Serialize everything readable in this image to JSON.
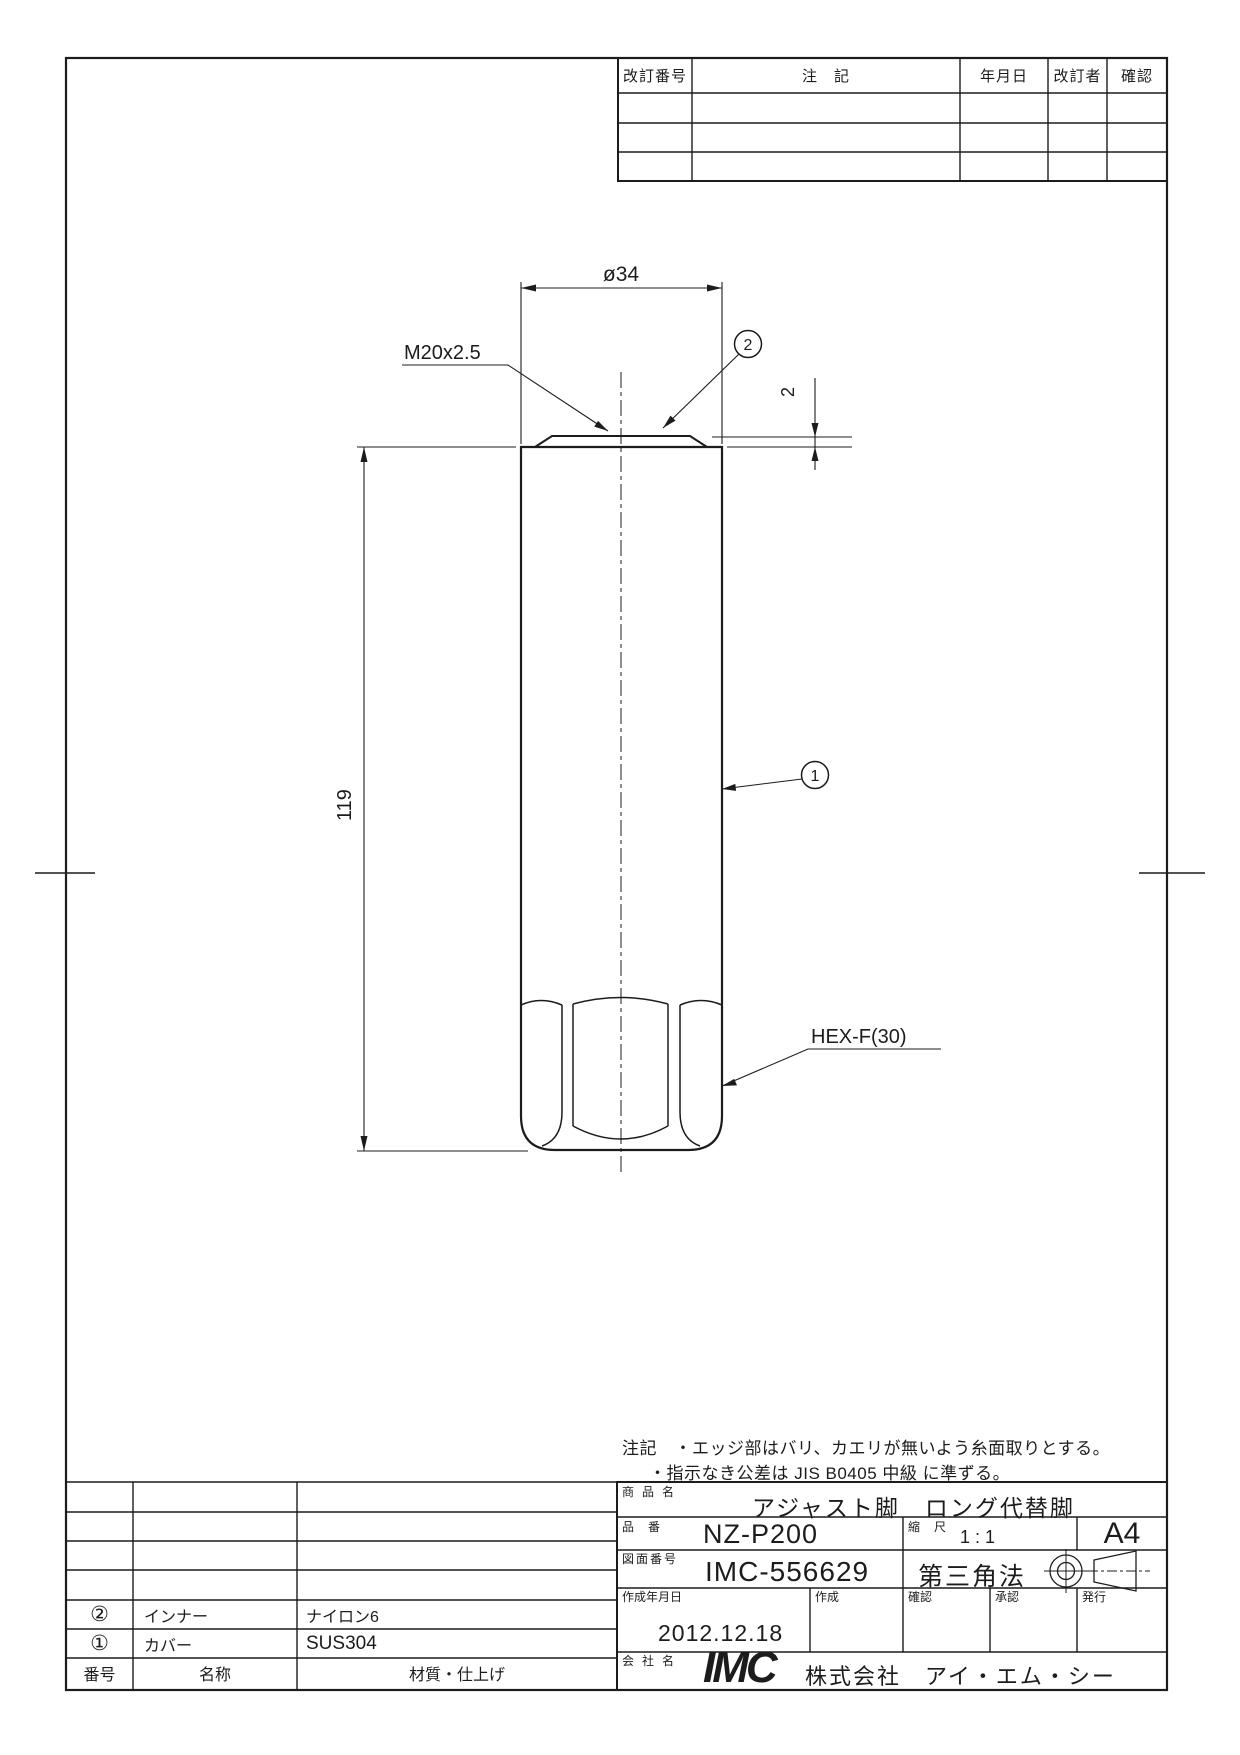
{
  "revision_table": {
    "col_revision_no": "改訂番号",
    "col_note": "注　記",
    "col_date": "年月日",
    "col_reviser": "改訂者",
    "col_confirm": "確認"
  },
  "drawing": {
    "diameter_dim": "ø34",
    "thread_callout": "M20x2.5",
    "cap_thickness_dim": "2",
    "length_dim": "119",
    "hex_callout": "HEX-F(30)",
    "balloon_1": "1",
    "balloon_2": "2"
  },
  "notes": {
    "line1": "注記　・エッジ部はバリ、カエリが無いよう糸面取りとする。",
    "line2": "・指示なき公差は JIS B0405 中級 に準ずる。"
  },
  "title_block": {
    "product_name_label": "商品名",
    "product_name": "アジャスト脚　ロング代替脚",
    "part_no_label": "品番",
    "part_no": "NZ-P200",
    "scale_label": "縮尺",
    "scale": "1 : 1",
    "paper_size": "A4",
    "drawing_no_label": "図面番号",
    "drawing_no": "IMC-556629",
    "projection": "第三角法",
    "date_label": "作成年月日",
    "date": "2012.12.18",
    "created_label": "作成",
    "checked_label": "確認",
    "approved_label": "承認",
    "issued_label": "発行",
    "company_label": "会社名",
    "company_logo": "IMC",
    "company_name": "株式会社　アイ・エム・シー"
  },
  "parts_table": {
    "header": {
      "no": "番号",
      "name": "名称",
      "material": "材質・仕上げ"
    },
    "rows": [
      {
        "no": "②",
        "name": "インナー",
        "material": "ナイロン6"
      },
      {
        "no": "①",
        "name": "カバー",
        "material": "SUS304"
      }
    ]
  }
}
